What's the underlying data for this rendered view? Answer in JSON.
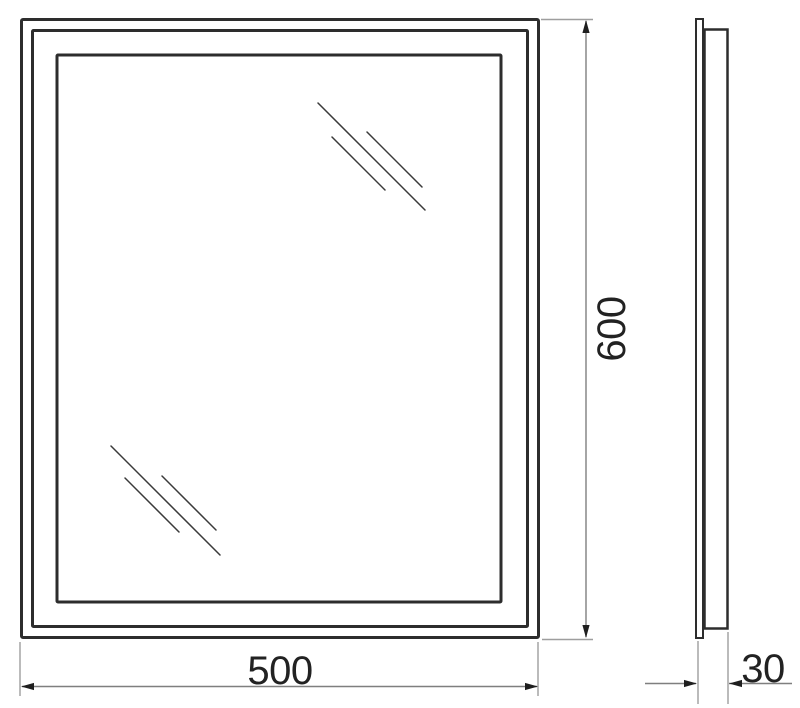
{
  "drawing": {
    "dimensions": {
      "width": {
        "value": "500"
      },
      "height": {
        "value": "600"
      },
      "depth": {
        "value": "30"
      }
    },
    "colors": {
      "outline": "#2d2d2d",
      "hatch": "#3a3a3a",
      "dimension_line": "#7f7f7f",
      "extension_line": "#9e9e9e",
      "arrowhead": "#1f1f1f",
      "text": "#222222",
      "background": "#ffffff"
    },
    "icons": {
      "glass_hatch": "glass-reflection-hatch"
    }
  }
}
